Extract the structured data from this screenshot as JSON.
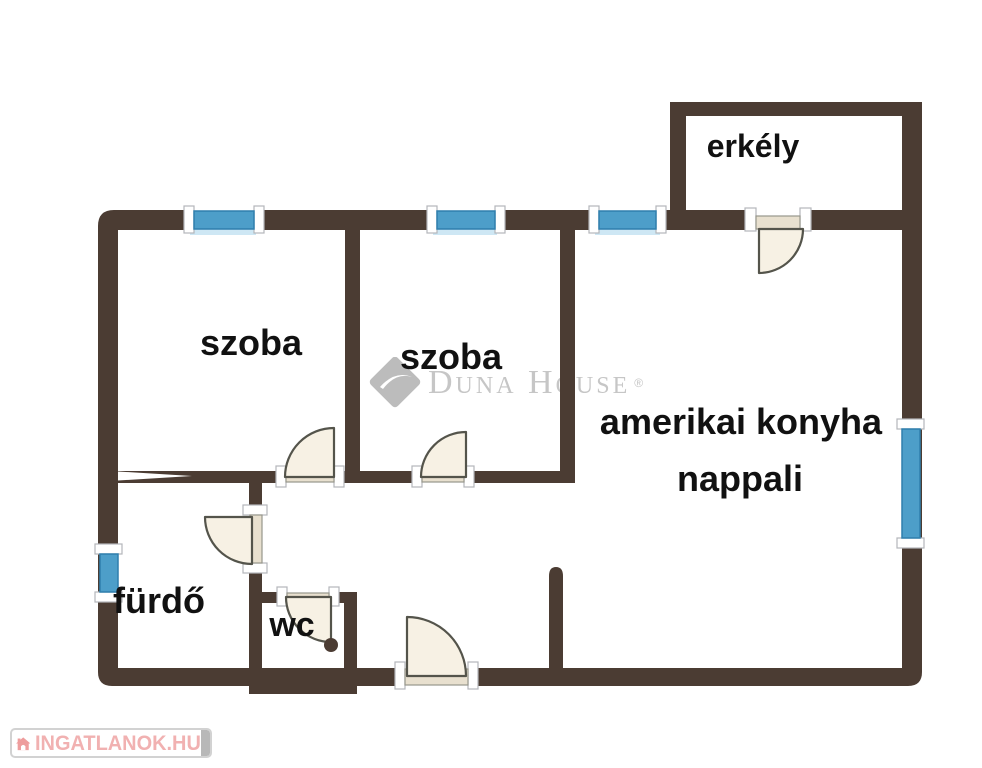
{
  "floor_plan": {
    "rooms": {
      "balcony": {
        "label": "erkély"
      },
      "room1": {
        "label": "szoba"
      },
      "room2": {
        "label": "szoba"
      },
      "living_room": {
        "label_line1": "amerikai konyha",
        "label_line2": "nappali"
      },
      "bathroom": {
        "label": "fürdő"
      },
      "toilet": {
        "label": "wc"
      }
    },
    "features": {
      "windows": 5,
      "doors": 6,
      "window_icon": "blue-window-glass",
      "door_icon": "quarter-circle-door-swing"
    }
  },
  "watermark": {
    "brand_name": "Duna House",
    "registered_mark": "®",
    "icon": "duna-house-diamond-icon"
  },
  "site_badge": {
    "site_name": "INGATLANOK.HU",
    "icon": "house-icon"
  },
  "theme": {
    "wall-color": "#4b3c33",
    "window-blue": "#4d9ec9",
    "window-edge": "#2f7fad",
    "window-glow": "#c6e3f2",
    "door-fill": "#f7f1e4",
    "door-stroke": "#54544b",
    "doorbar-fill": "#e8e0cf",
    "doorbar-stroke": "#97968c",
    "cap-stroke": "#b3b6ba",
    "watermark-grey": "#c6c6c6",
    "logo-pink": "#f1b1b1",
    "logo-house-pink": "#ee9d9d",
    "label-black": "#111111"
  }
}
